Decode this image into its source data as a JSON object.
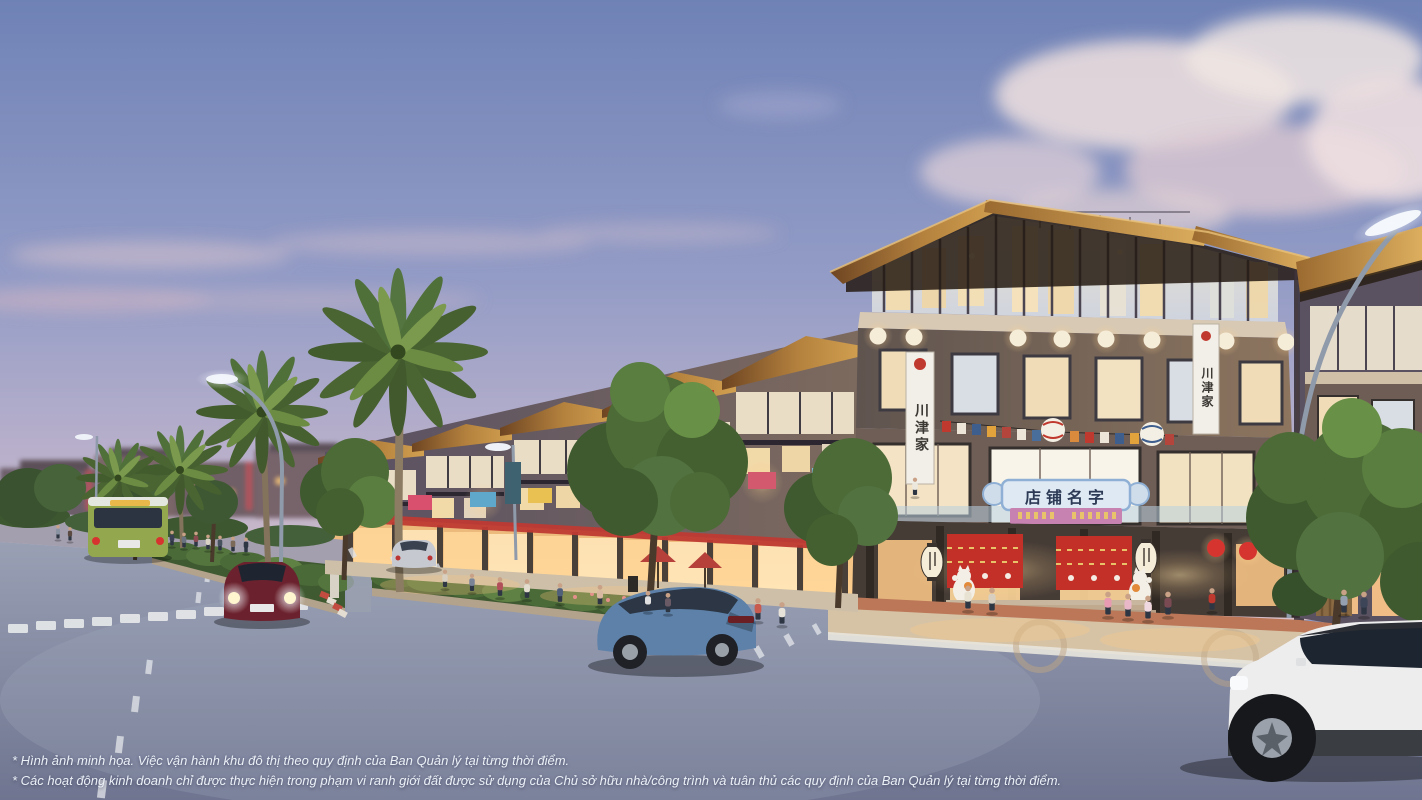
{
  "disclaimer": {
    "line1": "* Hình ảnh minh họa. Việc vận hành khu đô thị theo quy định của Ban Quản lý tại từng thời điểm.",
    "line2": "* Các hoạt động kinh doanh chỉ được thực hiện trong phạm vi ranh giới đất được sử dụng của Chủ sở hữu nhà/công trình và tuân thủ các quy định của Ban Quản lý tại từng thời điểm."
  },
  "signs": {
    "shop_plaque": "店铺名字",
    "vertical_banner": "川津家"
  },
  "palette": {
    "sky_top": "#6f82b6",
    "sky_mid": "#939cc6",
    "sky_low": "#b7afcb",
    "sky_horizon": "#d6bec8",
    "road_far": "#99a0b4",
    "road_near": "#6f7590",
    "roof_dark": "#6e4522",
    "roof_light": "#d2a050",
    "wall_dark": "#585063",
    "wall_warm": "#8d755f",
    "awning_red": "#bf3a33",
    "noren_red": "#c23028",
    "shop_glow": "#ffd190",
    "lantern_white": "#f6edd9",
    "lantern_red": "#d6352f",
    "plaque_bg": "#dfe9f4",
    "plaque_border": "#8fb0d4",
    "band_pink": "#c782b2",
    "seal_red": "#c0392f",
    "hedge": "#3f5a31",
    "hedge_light": "#5f8144",
    "palm_green": "#4a6532",
    "sidewalk": "#d6c3a6",
    "paver_red": "#bb7757",
    "bus_green": "#93a84e",
    "car_red": "#6b222e",
    "car_silver": "#c6c9cf",
    "car_blue": "#5d81a8",
    "suv_white": "#ededee",
    "pole_gray": "#8f9aaa",
    "banner_white": "#f2efe8"
  }
}
